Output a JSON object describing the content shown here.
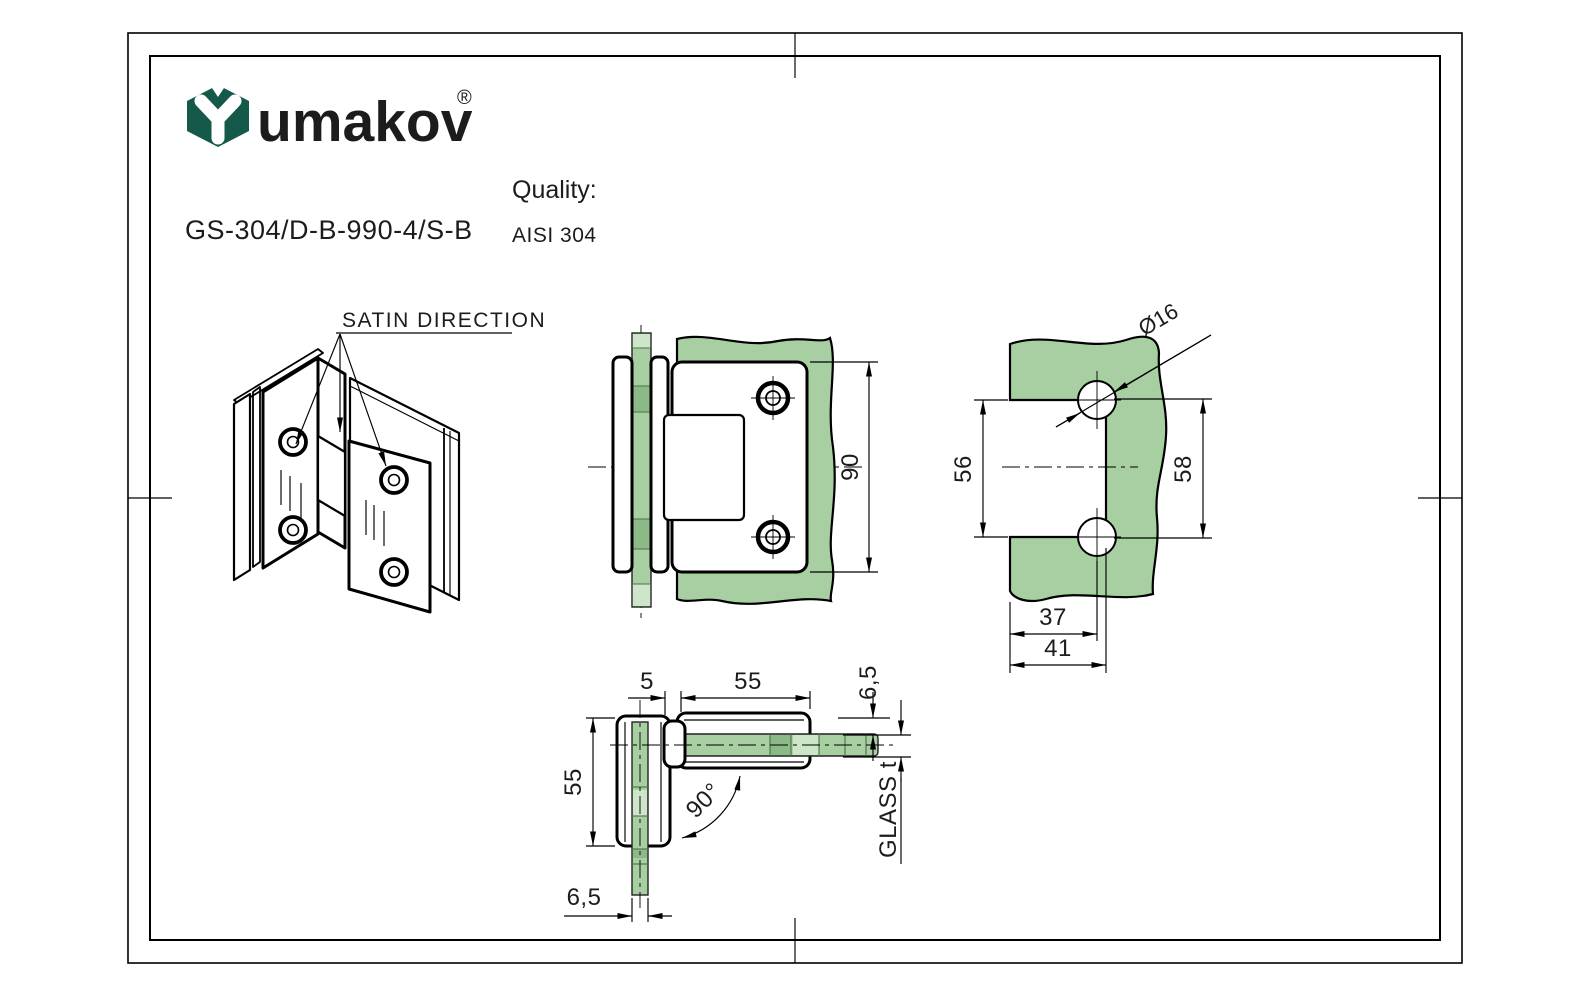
{
  "header": {
    "brand": "umakov",
    "registered_mark": "®",
    "product_code": "GS-304/D-B-990-4/S-B",
    "quality_label": "Quality:",
    "quality_value": "AISI 304"
  },
  "colors": {
    "logo_green": "#14594a",
    "glass_green": "#a7cfa1",
    "glass_dark": "#8cba87",
    "glass_light": "#cde5c8",
    "line": "#000000"
  },
  "views": {
    "isometric": {
      "label": "SATIN DIRECTION"
    },
    "front": {
      "dim_height": "90"
    },
    "glass_cutout": {
      "dim_hole_diameter": "Ø16",
      "dim_cutout_height": "56",
      "dim_hole_pitch": "58",
      "dim_hole_offset": "37",
      "dim_cutout_width": "41"
    },
    "top": {
      "dim_gap": "5",
      "dim_leaf_length": "55",
      "dim_plate_offset": "6,5",
      "dim_leaf_length_2": "55",
      "dim_angle": "90°",
      "dim_glass_offset": "6,5",
      "glass_thickness_label": "GLASS t"
    }
  }
}
